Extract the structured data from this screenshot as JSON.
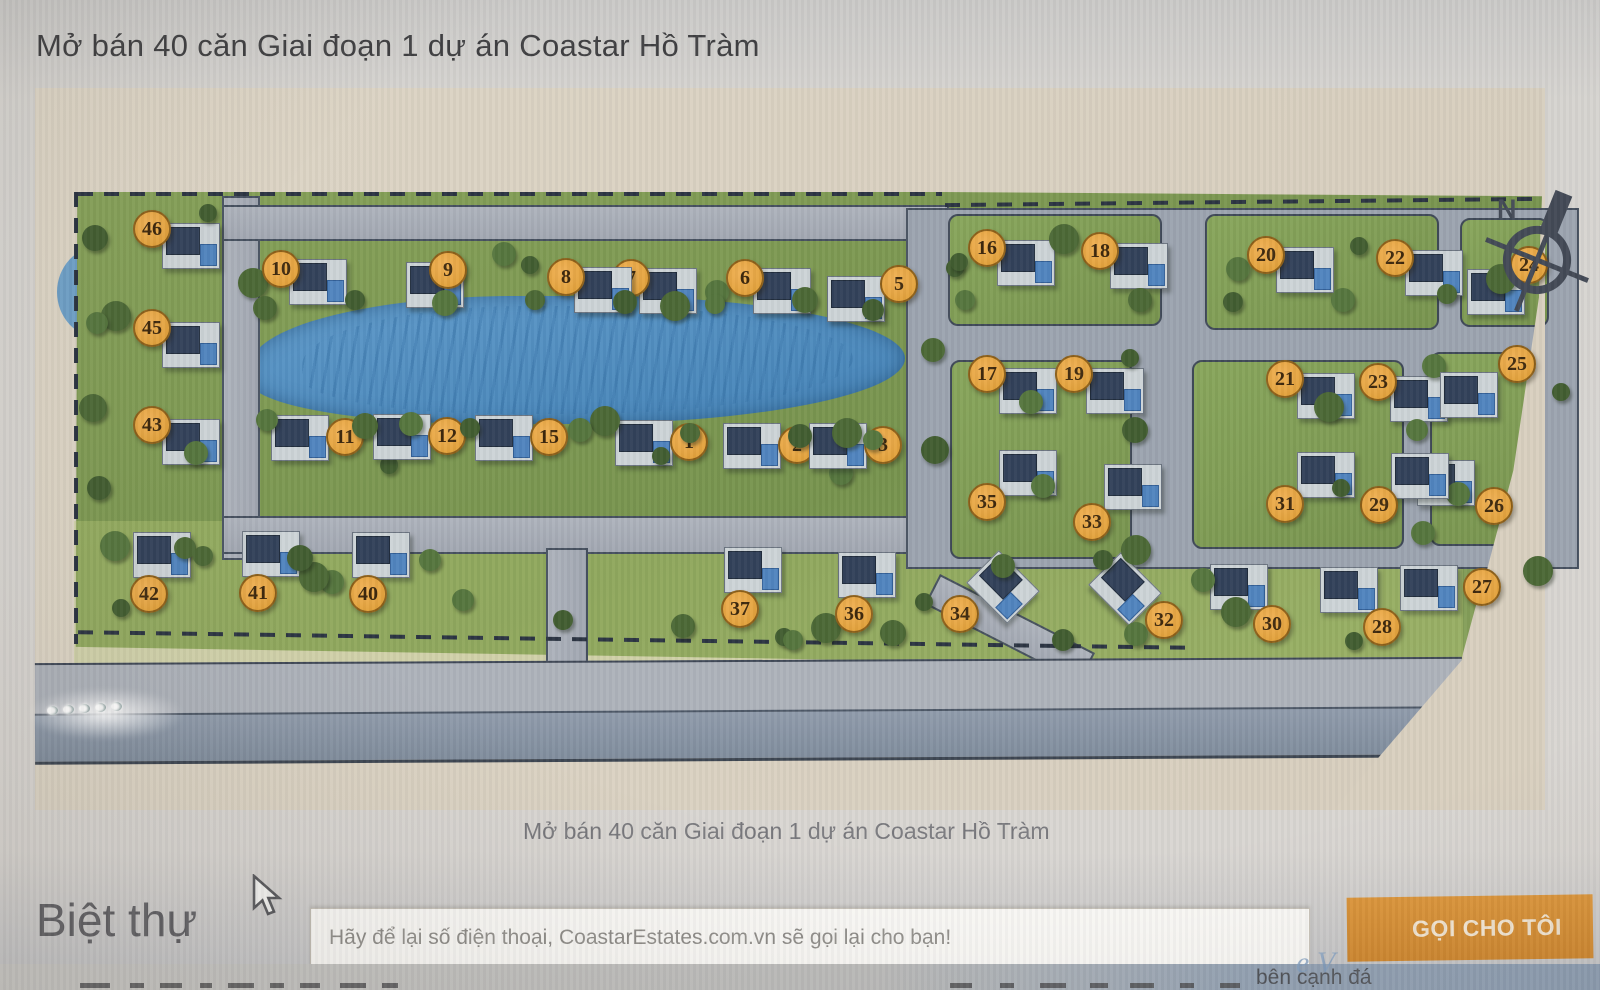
{
  "page": {
    "title": "Mở bán 40 căn Giai đoạn 1 dự án Coastar Hồ Tràm",
    "caption": "Mở bán 40 căn Giai đoạn 1 dự án Coastar Hồ Tràm",
    "section_heading": "Biệt thự"
  },
  "form": {
    "placeholder": "Hãy để lại số điện thoại, CoastarEstates.com.vn sẽ gọi lại cho bạn!",
    "button_label": "GỌI CHO TÔI"
  },
  "compass": {
    "label": "N"
  },
  "fragments": {
    "watermark": "e V",
    "bottom_right": "bên cạnh đá"
  },
  "colors": {
    "marker_fill": "#e2a23a",
    "marker_text": "#3a2408",
    "button_bg": "#d68c2f",
    "lake": "#4a87bb",
    "grass": "#7d9950",
    "map_background": "#d8cfbe"
  },
  "map": {
    "units_on_sale": 40,
    "lots": [
      {
        "n": 1,
        "x": 687,
        "y": 440
      },
      {
        "n": 2,
        "x": 795,
        "y": 443
      },
      {
        "n": 3,
        "x": 881,
        "y": 443
      },
      {
        "n": 5,
        "x": 897,
        "y": 282
      },
      {
        "n": 6,
        "x": 743,
        "y": 276
      },
      {
        "n": 7,
        "x": 629,
        "y": 276
      },
      {
        "n": 8,
        "x": 564,
        "y": 275
      },
      {
        "n": 9,
        "x": 446,
        "y": 268
      },
      {
        "n": 10,
        "x": 279,
        "y": 267
      },
      {
        "n": 11,
        "x": 343,
        "y": 435
      },
      {
        "n": 12,
        "x": 445,
        "y": 434
      },
      {
        "n": 15,
        "x": 547,
        "y": 435
      },
      {
        "n": 16,
        "x": 985,
        "y": 246
      },
      {
        "n": 17,
        "x": 985,
        "y": 372
      },
      {
        "n": 18,
        "x": 1098,
        "y": 249
      },
      {
        "n": 19,
        "x": 1072,
        "y": 372
      },
      {
        "n": 20,
        "x": 1264,
        "y": 253
      },
      {
        "n": 21,
        "x": 1283,
        "y": 377
      },
      {
        "n": 22,
        "x": 1393,
        "y": 256
      },
      {
        "n": 23,
        "x": 1376,
        "y": 380
      },
      {
        "n": 24,
        "x": 1527,
        "y": 263
      },
      {
        "n": 25,
        "x": 1515,
        "y": 362
      },
      {
        "n": 26,
        "x": 1492,
        "y": 504
      },
      {
        "n": 27,
        "x": 1480,
        "y": 585
      },
      {
        "n": 28,
        "x": 1380,
        "y": 625
      },
      {
        "n": 29,
        "x": 1377,
        "y": 503
      },
      {
        "n": 30,
        "x": 1270,
        "y": 622
      },
      {
        "n": 31,
        "x": 1283,
        "y": 502
      },
      {
        "n": 32,
        "x": 1162,
        "y": 618
      },
      {
        "n": 33,
        "x": 1090,
        "y": 520
      },
      {
        "n": 34,
        "x": 958,
        "y": 612
      },
      {
        "n": 35,
        "x": 985,
        "y": 500
      },
      {
        "n": 36,
        "x": 852,
        "y": 612
      },
      {
        "n": 37,
        "x": 738,
        "y": 607
      },
      {
        "n": 40,
        "x": 366,
        "y": 592
      },
      {
        "n": 41,
        "x": 256,
        "y": 591
      },
      {
        "n": 42,
        "x": 147,
        "y": 592
      },
      {
        "n": 43,
        "x": 150,
        "y": 423
      },
      {
        "n": 45,
        "x": 150,
        "y": 326
      },
      {
        "n": 46,
        "x": 150,
        "y": 227
      }
    ]
  }
}
